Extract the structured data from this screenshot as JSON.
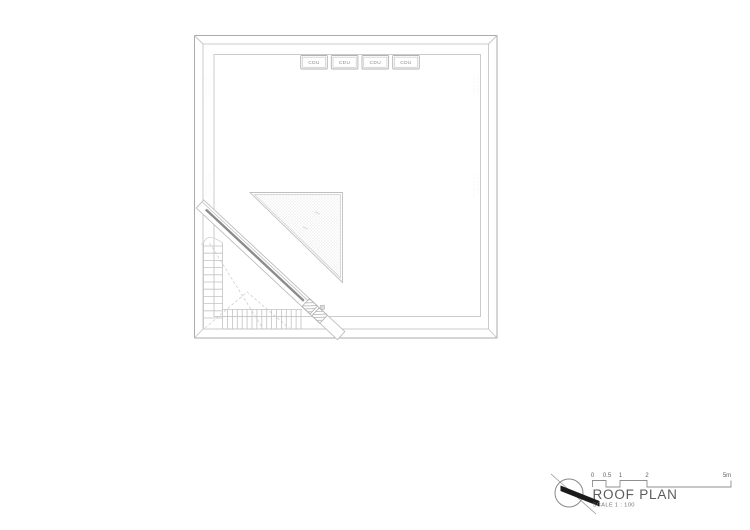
{
  "drawing": {
    "cdu_units": [
      {
        "label": "CDU"
      },
      {
        "label": "CDU"
      },
      {
        "label": "CDU"
      },
      {
        "label": "CDU"
      }
    ],
    "edge_annotations": {
      "mark_a": ":·.··:·.·:··.·",
      "mark_b": "·.·:··.·:·.··:"
    }
  },
  "title_block": {
    "title": "ROOF PLAN",
    "scale_note": "SCALE 1 : 100",
    "scale_bar_labels": [
      "0",
      "0.5",
      "1",
      "2",
      "5m"
    ]
  },
  "colors": {
    "background": "#ffffff",
    "line_light": "#c6c6c6",
    "line_medium": "#ababab",
    "beam_accent": "#8c8c8c",
    "north_needle": "#1a1a1a",
    "title_text": "#5c5c5c",
    "label_text": "#8a8a8a"
  }
}
